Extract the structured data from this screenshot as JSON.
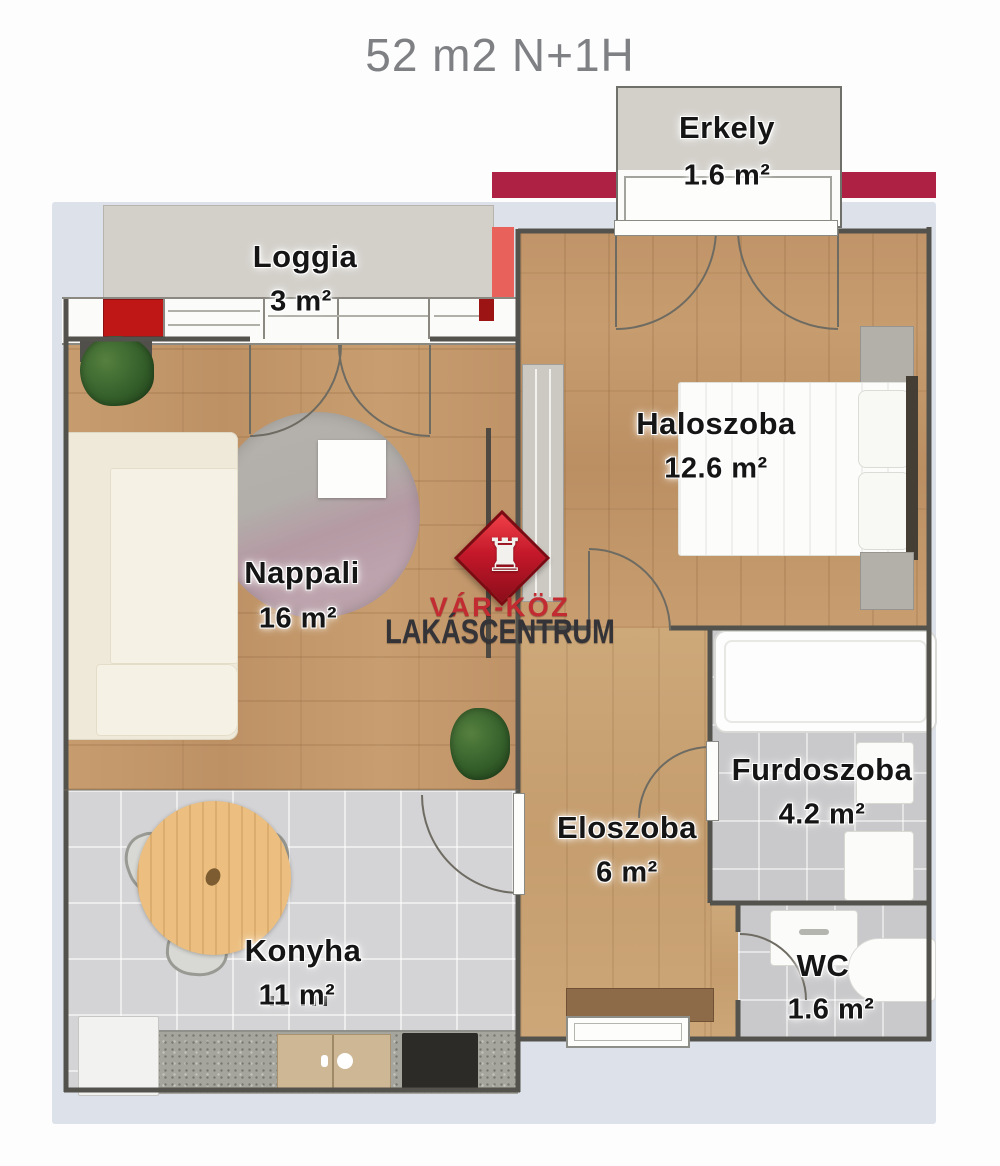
{
  "title": "52 m2 N+1H",
  "rooms": {
    "erkely": {
      "name": "Erkely",
      "area": "1.6 m²"
    },
    "loggia": {
      "name": "Loggia",
      "area": "3 m²"
    },
    "haloszoba": {
      "name": "Haloszoba",
      "area": "12.6 m²"
    },
    "nappali": {
      "name": "Nappali",
      "area": "16 m²"
    },
    "eloszoba": {
      "name": "Eloszoba",
      "area": "6 m²"
    },
    "furdoszoba": {
      "name": "Furdoszoba",
      "area": "4.2 m²"
    },
    "konyha": {
      "name": "Konyha",
      "area": "11 m²"
    },
    "wc": {
      "name": "WC",
      "area": "1.6 m²"
    }
  },
  "watermark": {
    "line1": "VÁR-KÖZ",
    "line2": "LAKÁSCENTRUM",
    "rook": "♜"
  },
  "colors": {
    "accent_crimson": "#ae2144",
    "bright_red": "#bf1616",
    "salmon": "#e8615a",
    "logo_red": "#c4182a",
    "wood_floor": "#c49a6c",
    "kitchen_tile": "#d4d4d6",
    "panel_background": "#dde1ea",
    "wall": "#54524c"
  }
}
